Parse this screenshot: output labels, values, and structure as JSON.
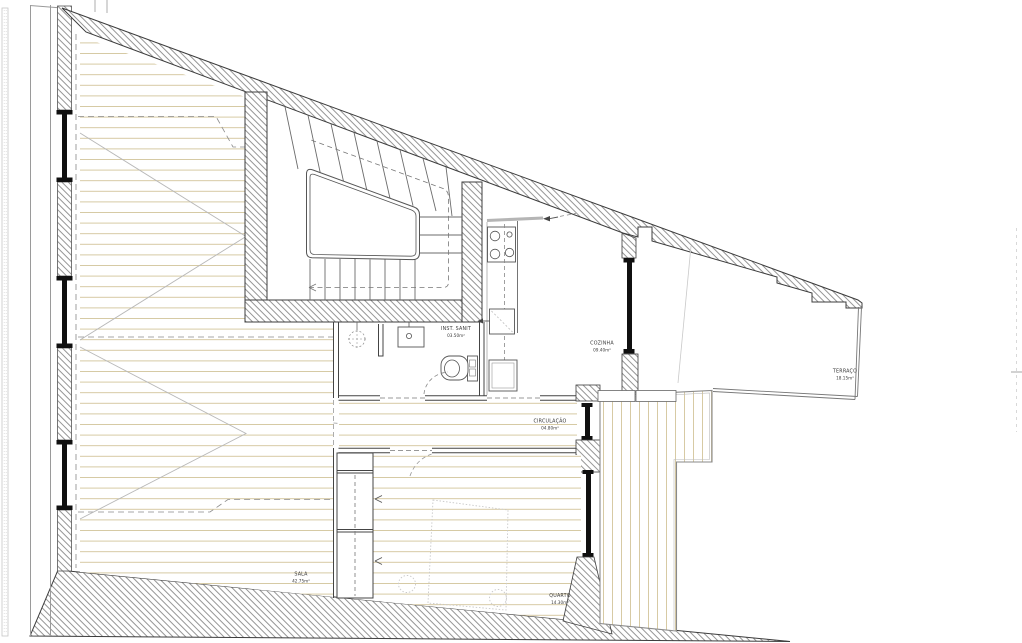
{
  "plan": {
    "title": "apartment floor plan",
    "rooms": {
      "sala": {
        "name": "SALA",
        "area": "42.75m²"
      },
      "quarto": {
        "name": "QUARTO",
        "area": "14.30m²"
      },
      "circulacao": {
        "name": "CIRCULAÇÃO",
        "area": "04.80m²"
      },
      "inst_sanit": {
        "name": "INST. SANIT",
        "area": "03.50m²"
      },
      "cozinha": {
        "name": "COZINHA",
        "area": "09.40m²"
      },
      "terraco": {
        "name": "TERRAÇO",
        "area": "18.15m²"
      }
    },
    "colors": {
      "wall_line": "#3c3c3c",
      "hatch_line": "#8a8a8a",
      "floor_line": "#d3c49a",
      "glazing": "#101010",
      "label_text": "#3a3a3a",
      "dashed_projection": "#8a8a8a"
    }
  }
}
